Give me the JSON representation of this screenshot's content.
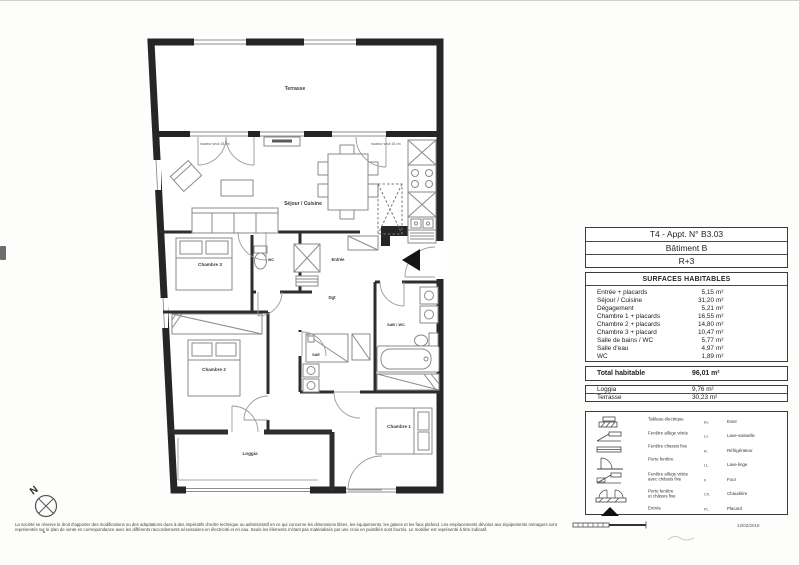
{
  "plan": {
    "rooms": {
      "terrasse": "Terrasse",
      "sejour": "Séjour / Cuisine",
      "chambre3": "Chambre 3",
      "wc": "WC",
      "entree": "Entrée",
      "dgt": "Dgt",
      "sdb": "SdB / WC",
      "sde": "SdE",
      "chambre2": "Chambre 2",
      "chambre1": "Chambre 1",
      "loggia": "Loggia"
    },
    "annotations": {
      "seuil_left": "hauteur seuil 18 cm",
      "seuil_right": "hauteur seuil 18 cm",
      "compass": "N"
    }
  },
  "header": {
    "rows": [
      "T4 - Appt. N° B3.03",
      "Bâtiment B",
      "R+3"
    ]
  },
  "surfaces": {
    "title": "SURFACES HABITABLES",
    "rows": [
      {
        "label": "Entrée + placards",
        "value": "5,15",
        "unit": "m²"
      },
      {
        "label": "Séjour / Cuisine",
        "value": "31,20",
        "unit": "m²"
      },
      {
        "label": "Dégagement",
        "value": "5,21",
        "unit": "m²"
      },
      {
        "label": "Chambre 1 + placards",
        "value": "16,55",
        "unit": "m²"
      },
      {
        "label": "Chambre 2 + placards",
        "value": "14,80",
        "unit": "m²"
      },
      {
        "label": "Chambre 3 + placard",
        "value": "10,47",
        "unit": "m²"
      },
      {
        "label": "Salle de bains / WC",
        "value": "5,77",
        "unit": "m²"
      },
      {
        "label": "Salle d'eau",
        "value": "4,97",
        "unit": "m²"
      },
      {
        "label": "WC",
        "value": "1,89",
        "unit": "m²"
      }
    ]
  },
  "totals": {
    "total": {
      "label": "Total habitable",
      "value": "96,01 m²"
    },
    "annex": [
      {
        "label": "Loggia",
        "value": "9,76 m²"
      },
      {
        "label": "Terrasse",
        "value": "30,23 m²"
      }
    ]
  },
  "legend": {
    "symbols": [
      {
        "label": "Tableau électrique"
      },
      {
        "label": "Fenêtre allège vitrée"
      },
      {
        "label": "Fenêtre chassis fixe"
      },
      {
        "label": "Porte fenêtre"
      },
      {
        "label": "Fenêtre allège vitrée",
        "label2": "avec châssis fixe"
      },
      {
        "label": "Porte fenêtre",
        "label2": "et châssis fixe"
      },
      {
        "label": "Entrée"
      }
    ],
    "abbreviations": [
      {
        "abbr": "Ev.",
        "label": "Evier"
      },
      {
        "abbr": "Lv.",
        "label": "Lave-vaisselle"
      },
      {
        "abbr": "R.",
        "label": "Réfrigérateur"
      },
      {
        "abbr": "LL.",
        "label": "Lave-linge"
      },
      {
        "abbr": "F.",
        "label": "Four"
      },
      {
        "abbr": "Ch.",
        "label": "Chaudière"
      },
      {
        "abbr": "PL.",
        "label": "Placard"
      }
    ]
  },
  "footer": {
    "disclaimer": "La société se réserve le droit d'apporter des modifications ou des adaptations dues à des impératifs d'ordre technique ou administratif en ce qui concerne les dimensions libres, les équipements, les gaines et les faux plafond. Les emplacements dévolus aux équipements ménagers sont représentés sur le plan de vente en correspondance avec les différents raccordements nécessaires en électricité et en eau. Seuls les éléments n'étant pas matérialisés par une croix en pointillés sont fournis. Le mobilier est représenté à titre indicatif.",
    "date": "12/02/2018"
  }
}
